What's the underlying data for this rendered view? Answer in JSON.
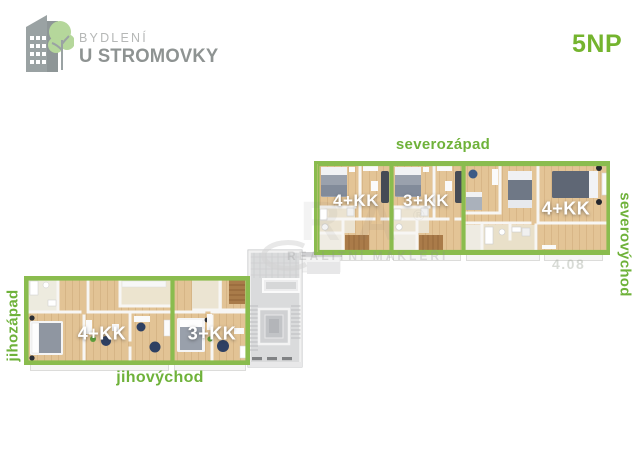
{
  "header": {
    "logo_line1": "BYDLENÍ",
    "logo_line2": "U STROMOVKY",
    "floor_label": "5NP"
  },
  "north_block": {
    "label_top": "severozápad",
    "label_right": "severovýchod",
    "units": [
      {
        "label": "4+KK"
      },
      {
        "label": "3+KK"
      },
      {
        "label": "4+KK"
      }
    ]
  },
  "south_block": {
    "label_left": "jihozápad",
    "label_bottom": "jihovýchod",
    "units": [
      {
        "label": "4+KK"
      },
      {
        "label": "3+KK"
      }
    ]
  },
  "watermark": {
    "big_text": "RA",
    "reg_mark": "®",
    "small_text": "REALITNÍ MAKLÉŘI",
    "unit_number": "4.08"
  },
  "colors": {
    "green_text": "#6fb23a",
    "green_border": "#8abc4e",
    "logo_gray": "#8e9392",
    "logo_light_gray": "#b6b8b7",
    "wood_floor": "#e3c496"
  }
}
